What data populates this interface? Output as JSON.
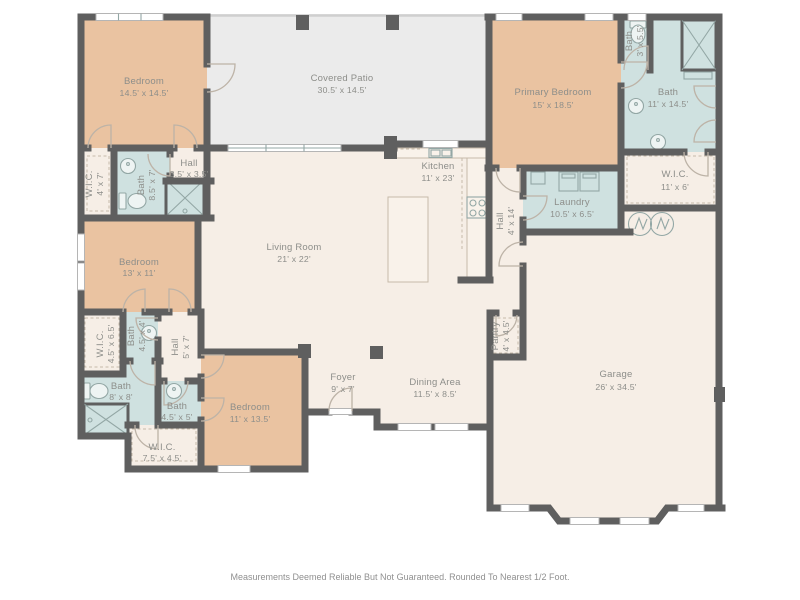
{
  "plan": {
    "rooms": {
      "bedroom_top_left": {
        "name": "Bedroom",
        "dims": "14.5' x 14.5'"
      },
      "covered_patio": {
        "name": "Covered Patio",
        "dims": "30.5' x 14.5'"
      },
      "primary_bedroom": {
        "name": "Primary Bedroom",
        "dims": "15' x 18.5'"
      },
      "bath_primary_wc": {
        "name": "Bath",
        "dims": "3' x 5.5'"
      },
      "bath_primary": {
        "name": "Bath",
        "dims": "11' x 14.5'"
      },
      "wic_primary": {
        "name": "W.I.C.",
        "dims": "11' x 6'"
      },
      "laundry": {
        "name": "Laundry",
        "dims": "10.5' x 6.5'"
      },
      "hall_primary": {
        "name": "Hall",
        "dims": "4' x 14'"
      },
      "kitchen": {
        "name": "Kitchen",
        "dims": "11' x 23'"
      },
      "living_room": {
        "name": "Living Room",
        "dims": "21' x 22'"
      },
      "wic_top_left": {
        "name": "W.I.C.",
        "dims": "4' x 7'"
      },
      "bath_top_left": {
        "name": "Bath",
        "dims": "8.5' x 7'"
      },
      "hall_small": {
        "name": "Hall",
        "dims": "3.5' x 3.5'"
      },
      "bedroom_mid_left": {
        "name": "Bedroom",
        "dims": "13' x 11'"
      },
      "wic_mid_left": {
        "name": "W.I.C.",
        "dims": "4.5' x 6.5'"
      },
      "bath_mid": {
        "name": "Bath",
        "dims": "4.5' x 4'"
      },
      "hall_lower": {
        "name": "Hall",
        "dims": "5' x 7'"
      },
      "bath_lower_left": {
        "name": "Bath",
        "dims": "8' x 8'"
      },
      "bath_lower_mid": {
        "name": "Bath",
        "dims": "4.5' x 5'"
      },
      "wic_lower": {
        "name": "W.I.C.",
        "dims": "7.5' x 4.5'"
      },
      "bedroom_bottom": {
        "name": "Bedroom",
        "dims": "11' x 13.5'"
      },
      "foyer": {
        "name": "Foyer",
        "dims": "9' x 7'"
      },
      "dining_area": {
        "name": "Dining Area",
        "dims": "11.5' x 8.5'"
      },
      "pantry": {
        "name": "Pantry",
        "dims": "4' x 4.5'"
      },
      "garage": {
        "name": "Garage",
        "dims": "26' x 34.5'"
      }
    },
    "footer": {
      "disclaimer": "Measurements Deemed Reliable But Not Guaranteed. Rounded To Nearest 1/2 Foot."
    },
    "fixtures": [
      "toilet-icon",
      "sink-icon",
      "shower-icon",
      "washer-icon",
      "dryer-icon",
      "water-heater-icon",
      "stove-icon",
      "kitchen-sink-icon",
      "kitchen-island",
      "door-swing",
      "window"
    ],
    "colors": {
      "wall": "#5f5f5f",
      "bedroom": "#eac3a1",
      "bath": "#cfe1e0",
      "floor": "#f6eee6",
      "patio": "#ebebeb",
      "label": "#8d8e8a",
      "winframe": "#b5b5b5",
      "door": "#bdb3a7",
      "fixture": "#93a7a5",
      "cabinet": "#c6baa9"
    }
  }
}
